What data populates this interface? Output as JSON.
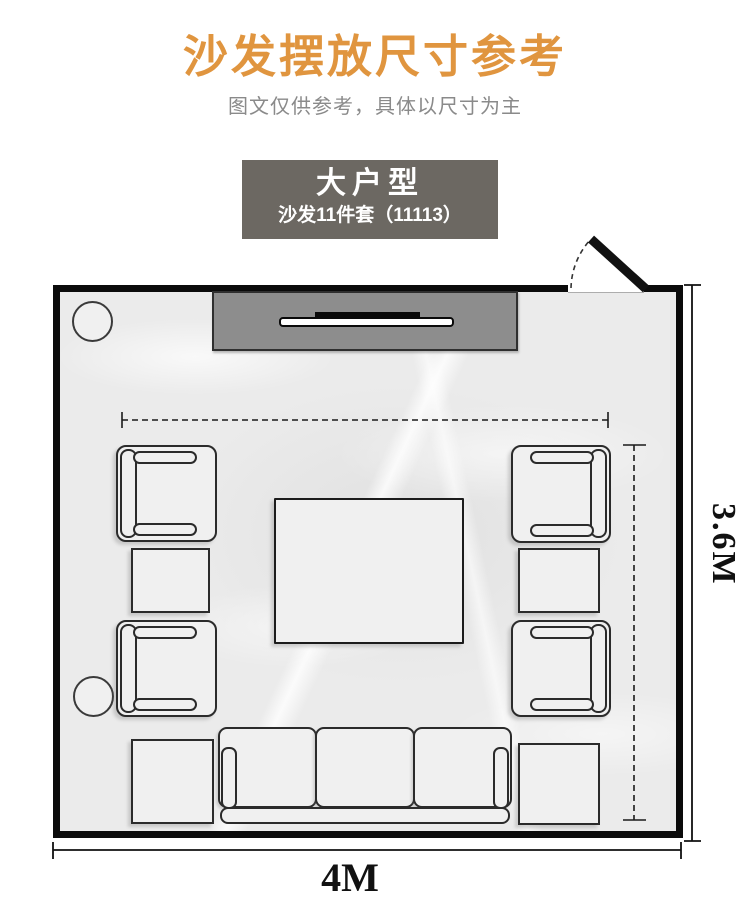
{
  "header": {
    "title": "沙发摆放尺寸参考",
    "subtitle": "图文仅供参考，具体以尺寸为主"
  },
  "type_card": {
    "title": "大户型",
    "subtitle": "沙发11件套（11113）"
  },
  "floor_plan": {
    "width_label": "4M",
    "depth_label": "3.6M",
    "furniture_count": 11
  },
  "colors": {
    "accent_title": "#E0953F",
    "subtitle_gray": "#8A8A8A",
    "card_background": "#6C6862",
    "card_text": "#FFFFFF",
    "wall": "#0B0B0B",
    "floor": "#EBEBEB",
    "tv_cabinet": "#8D8D8D",
    "furniture_fill": "#F0F0F0",
    "furniture_border": "#2B2B2B"
  }
}
